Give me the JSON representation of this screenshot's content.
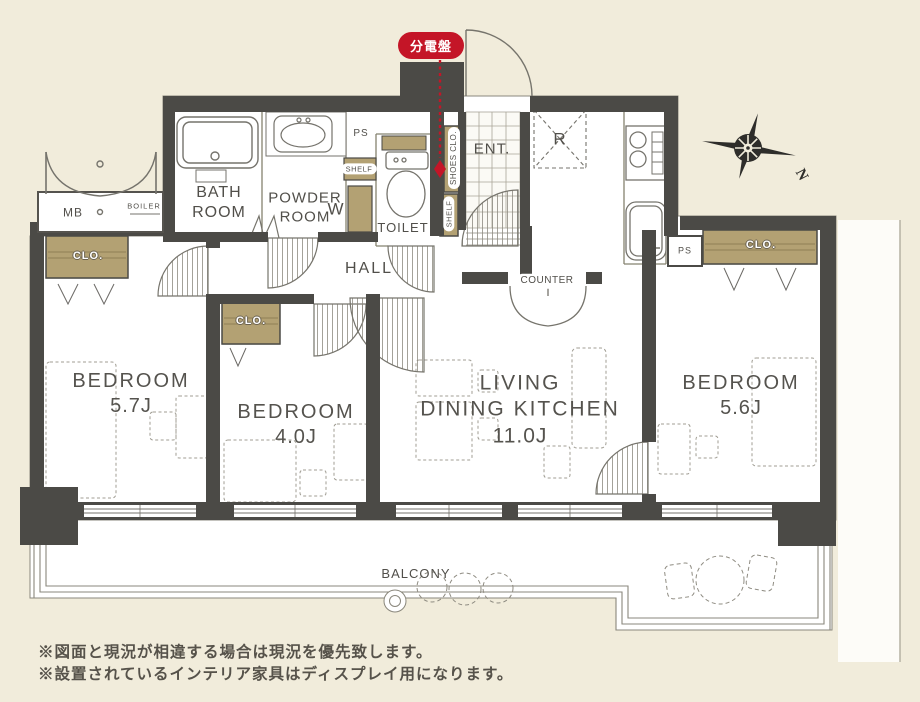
{
  "badge": {
    "label": "分電盤"
  },
  "compass": {
    "north": "N"
  },
  "labels": {
    "bath": "BATH ROOM",
    "powder": "POWDER ROOM",
    "toilet": "TOILET",
    "ent": "ENT.",
    "shoes_clo": "SHOES CLO.",
    "shelf": "SHELF",
    "w": "W",
    "ps": "PS",
    "r": "R",
    "mb": "MB",
    "boiler": "BOILER",
    "hall": "HALL",
    "counter": "COUNTER",
    "clo": "CLO.",
    "balcony": "BALCONY"
  },
  "rooms": {
    "bedroom_left": {
      "name": "BEDROOM",
      "size": "5.7J"
    },
    "bedroom_middle": {
      "name": "BEDROOM",
      "size": "4.0J"
    },
    "ldk": {
      "line1": "LIVING",
      "line2": "DINING KITCHEN",
      "size": "11.0J"
    },
    "bedroom_right": {
      "name": "BEDROOM",
      "size": "5.6J"
    }
  },
  "notes": {
    "line1": "※図面と現況が相違する場合は現況を優先致します。",
    "line2": "※設置されているインテリア家具はディスプレイ用になります。"
  },
  "colors": {
    "background": "#f1ecdb",
    "wall": "#4b4a46",
    "floor": "#ffffff",
    "closet": "#b3a173",
    "accent_red": "#c41527",
    "line": "#8a877c",
    "text": "#514f4a"
  }
}
